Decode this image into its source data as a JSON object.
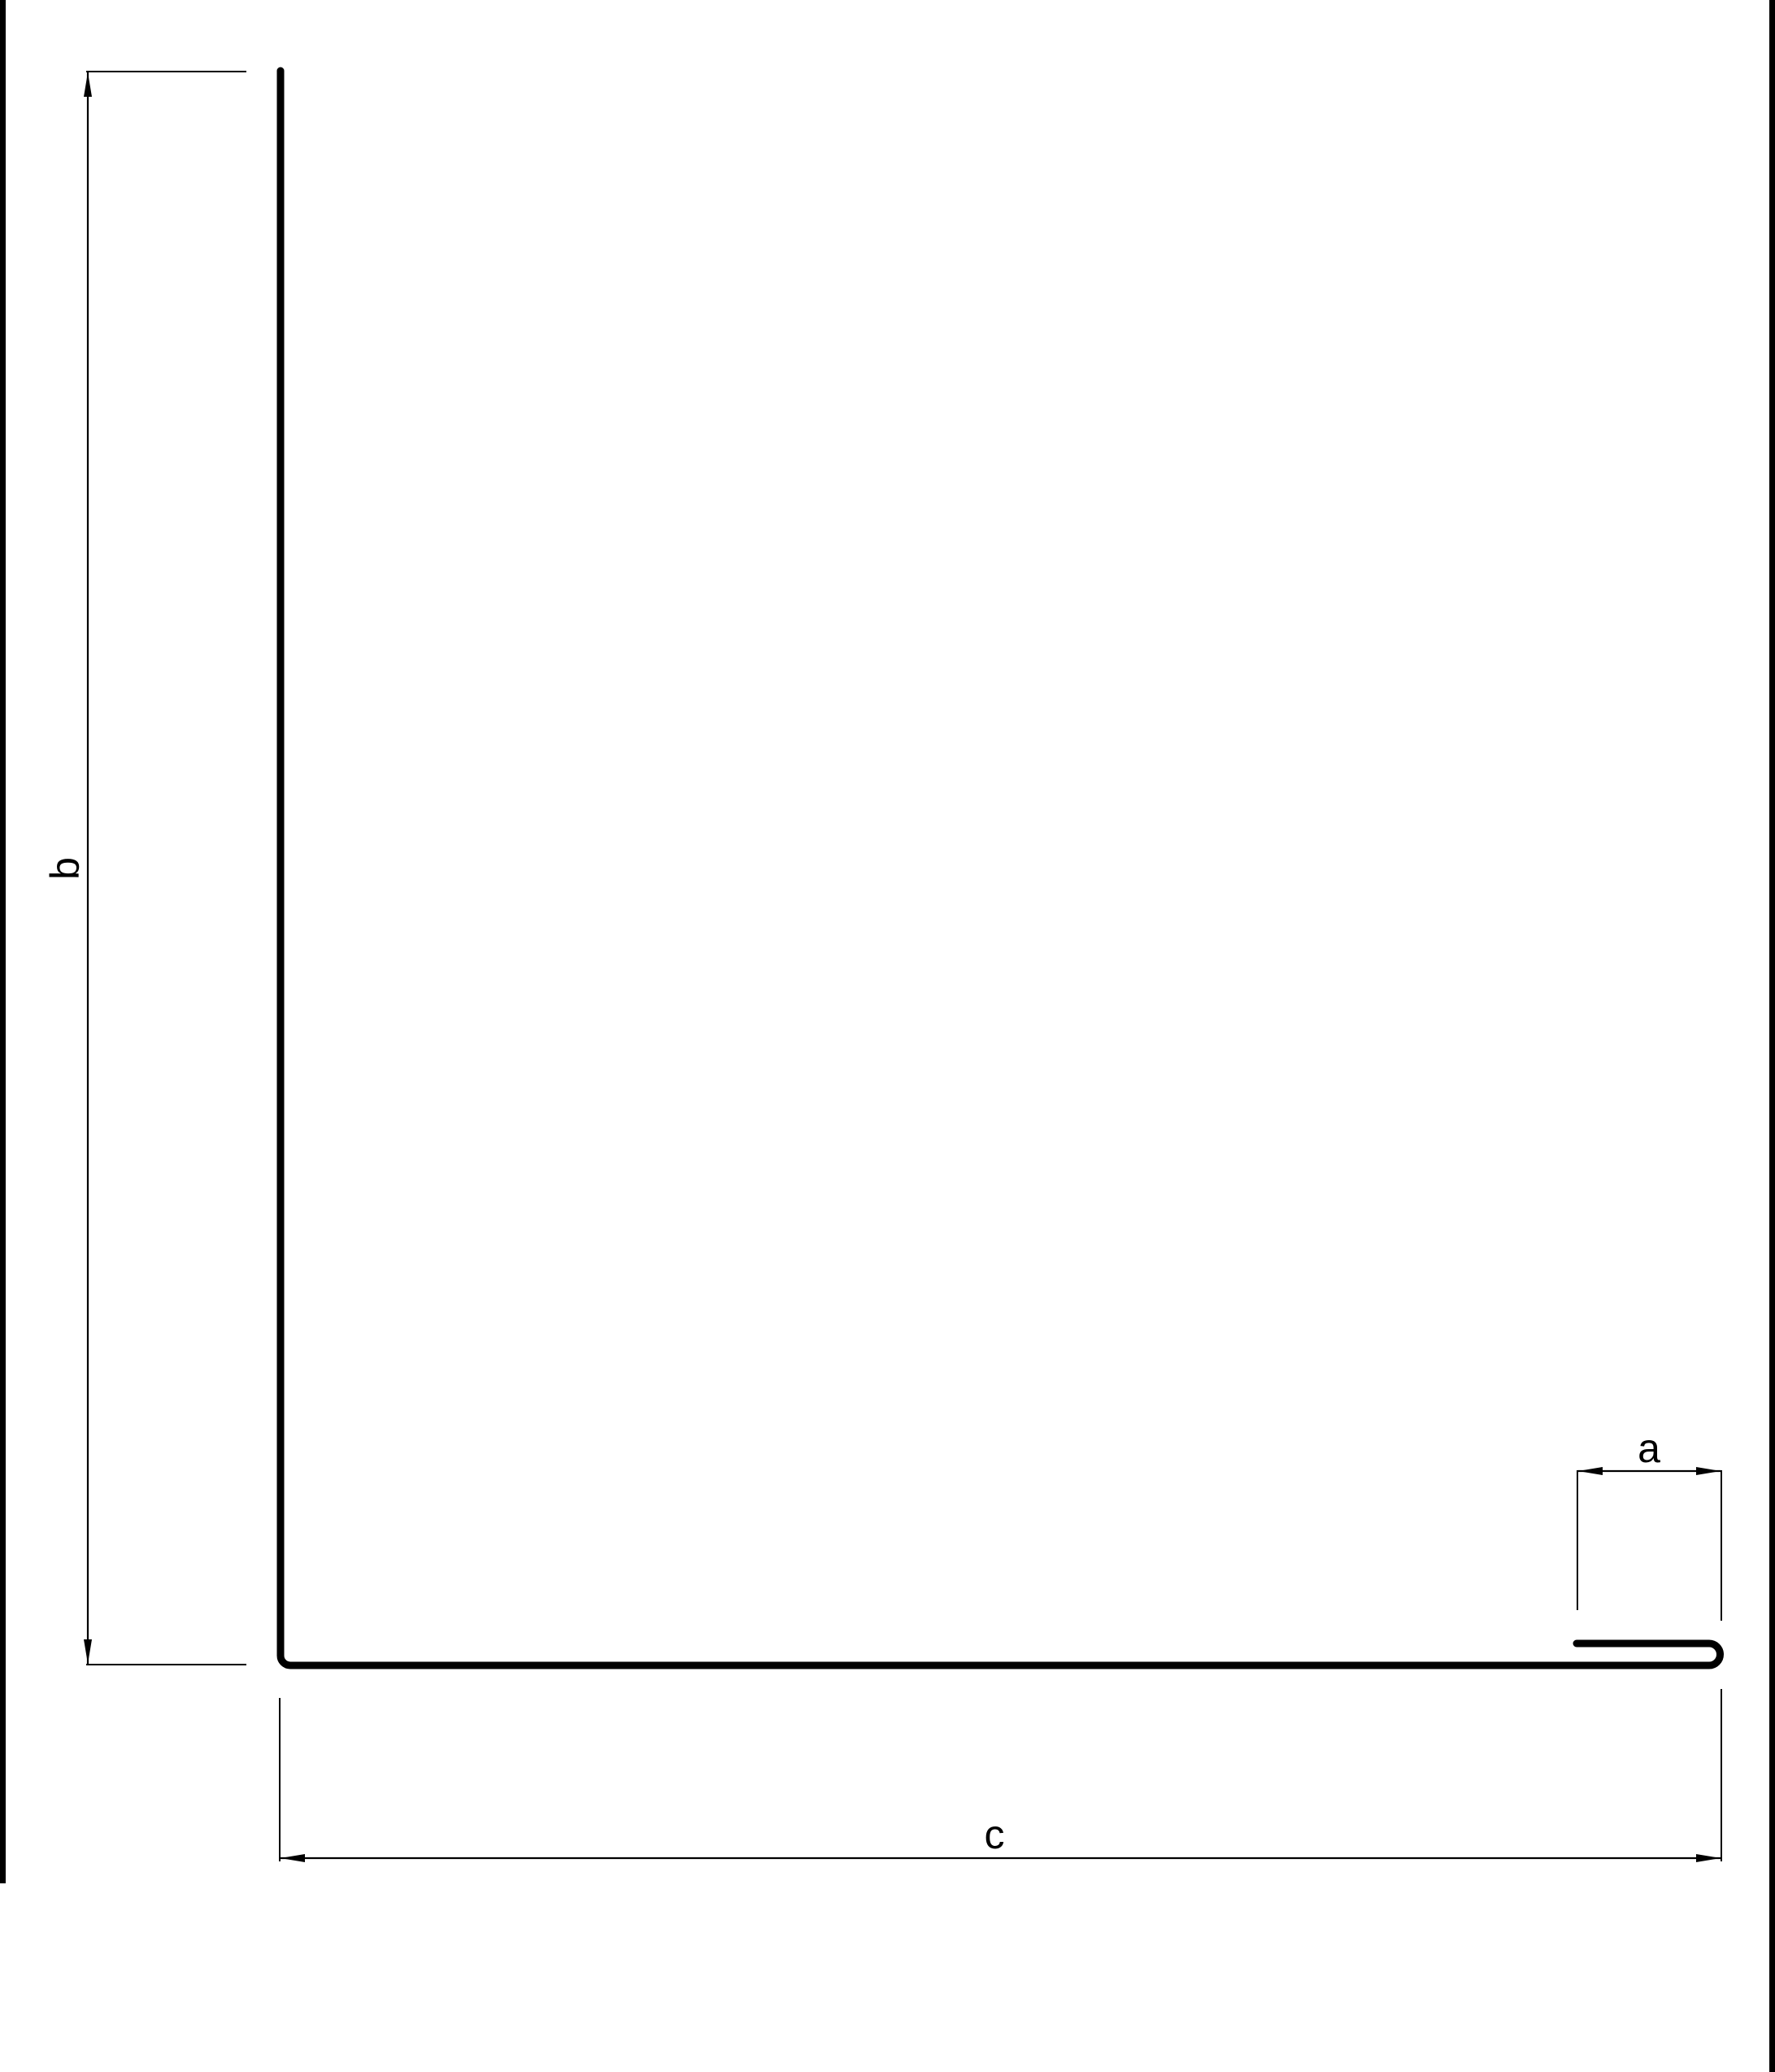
{
  "drawing": {
    "dimension_labels": {
      "a": "a",
      "b": "b",
      "c": "c"
    }
  },
  "colors": {
    "background": "#ffffff",
    "line": "#000000",
    "dimension": "#000000",
    "edge_bar": "#000000"
  }
}
